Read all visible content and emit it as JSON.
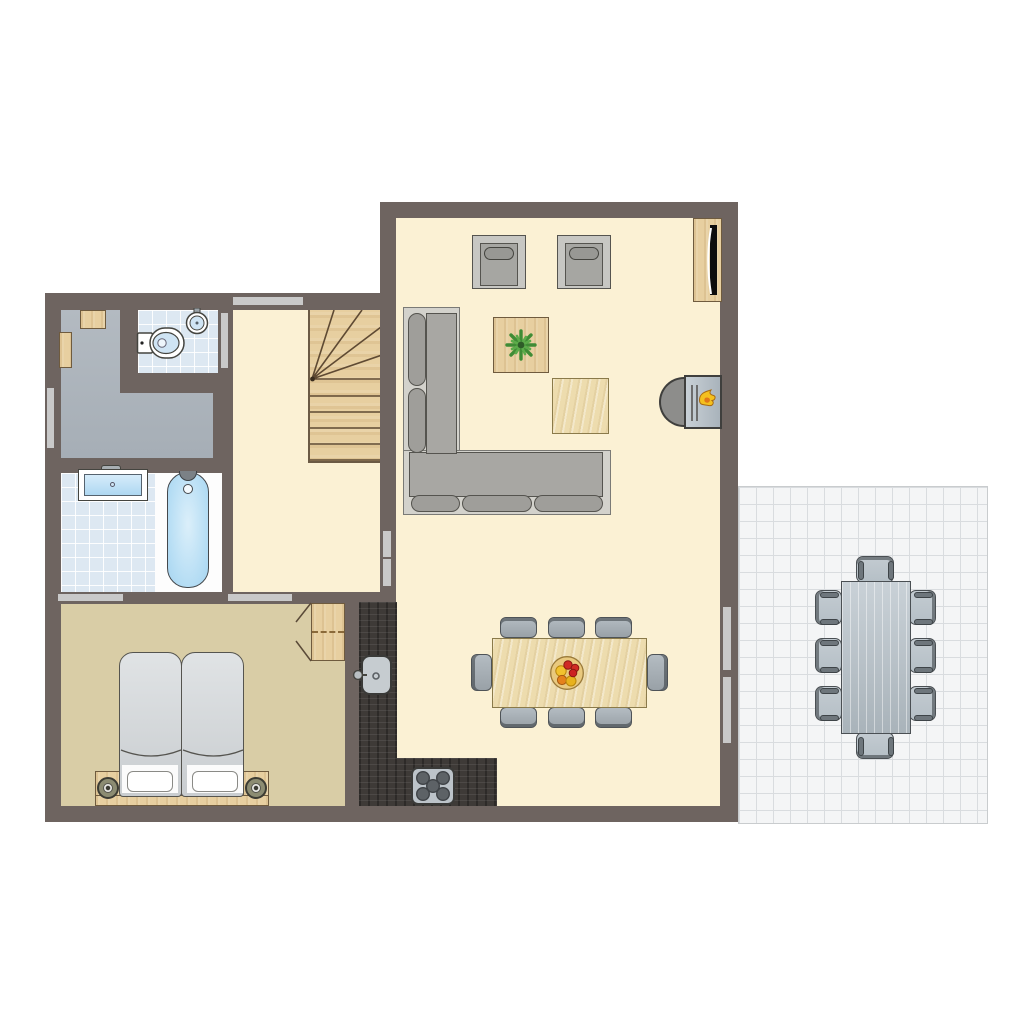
{
  "document": {
    "kind": "floor-plan",
    "view": "top-down 2D architectural drawing",
    "visible_text": "none — plan contains no labels or dimensions",
    "floor": "ground floor of a holiday home with terrace"
  },
  "colors": {
    "wall": "#6e6460",
    "floor-cream": "#fbf1d4",
    "floor-bedroom": "#d9cda6",
    "floor-utility": "#a6aeb6",
    "tile-bath": "#dde8f2",
    "floor-bath-white": "#fdfdfd",
    "water-blue": "#b5ddf4",
    "wood": "#e7cfa0",
    "wood-light": "#eddcae",
    "counter-dark": "#3e3a37",
    "sofa-gray": "#a8a7a3",
    "sofa-platform": "#d3d2cc",
    "marker": "#c9c9c9",
    "terrace-tile": "#f4f5f6",
    "terrace-line": "#d9dcdf",
    "terrace-furniture": "#b5bfc6",
    "lamp-olive": "#8c8c72",
    "flame-yellow": "#f4c01e",
    "flame-orange": "#e07818",
    "plant-green": "#3f8c35",
    "fruit-red": "#cf2b24"
  },
  "rooms": [
    {
      "name": "living-room",
      "floor": "cream",
      "furniture": [
        "tv-sideboard with tv",
        "2 armchairs",
        "coffee-table with plant",
        "side-table",
        "corner sofa (L-shape)",
        "wood-burning stove with flame"
      ]
    },
    {
      "name": "dining-area",
      "floor": "cream",
      "furniture": [
        "rectangular wooden dining table",
        "8 gray dining chairs (3 top, 3 bottom, 1 left, 1 right)",
        "fruit bowl centerpiece"
      ]
    },
    {
      "name": "open-kitchen",
      "floor": "cream",
      "furniture": [
        "dark L-shaped counter",
        "sink with faucet",
        "hob with 5 burners"
      ]
    },
    {
      "name": "hallway",
      "floor": "cream",
      "furniture": [
        "winder staircase (quarter-turn, wood)"
      ]
    },
    {
      "name": "utility-room",
      "floor": "gray",
      "furniture": [
        "small cabinet",
        "wall shelf"
      ]
    },
    {
      "name": "toilet-room",
      "floor": "light-blue tiles",
      "furniture": [
        "toilet",
        "corner washbasin"
      ]
    },
    {
      "name": "bathroom",
      "floor": "light-blue tiles + white strip",
      "furniture": [
        "washbasin",
        "bathtub with faucet"
      ]
    },
    {
      "name": "bedroom",
      "floor": "tan",
      "furniture": [
        "double bed (2 mattresses, 2 pillows)",
        "headboard plank",
        "2 nightstands with round lamps",
        "wardrobe with dashed shelf line and open doors"
      ]
    },
    {
      "name": "terrace",
      "floor": "white tiles 17px grid",
      "furniture": [
        "gray plank garden table",
        "8 garden chairs (3 left, 3 right, 1 top, 1 bottom)"
      ]
    }
  ],
  "openings": [
    {
      "name": "front-door",
      "location": "top wall above hallway"
    },
    {
      "name": "toilet-door",
      "location": "wall between hallway and toilet-room"
    },
    {
      "name": "utility-window",
      "location": "left exterior wall of utility-room"
    },
    {
      "name": "bathroom-bedroom-door",
      "location": "wall between bathroom and bedroom"
    },
    {
      "name": "hallway-bedroom-door",
      "location": "wall between hallway and bedroom"
    },
    {
      "name": "hallway-living-door",
      "location": "wall between hallway and living room, double segment"
    },
    {
      "name": "terrace-sliding-door",
      "location": "right exterior wall to terrace, double segment"
    }
  ]
}
